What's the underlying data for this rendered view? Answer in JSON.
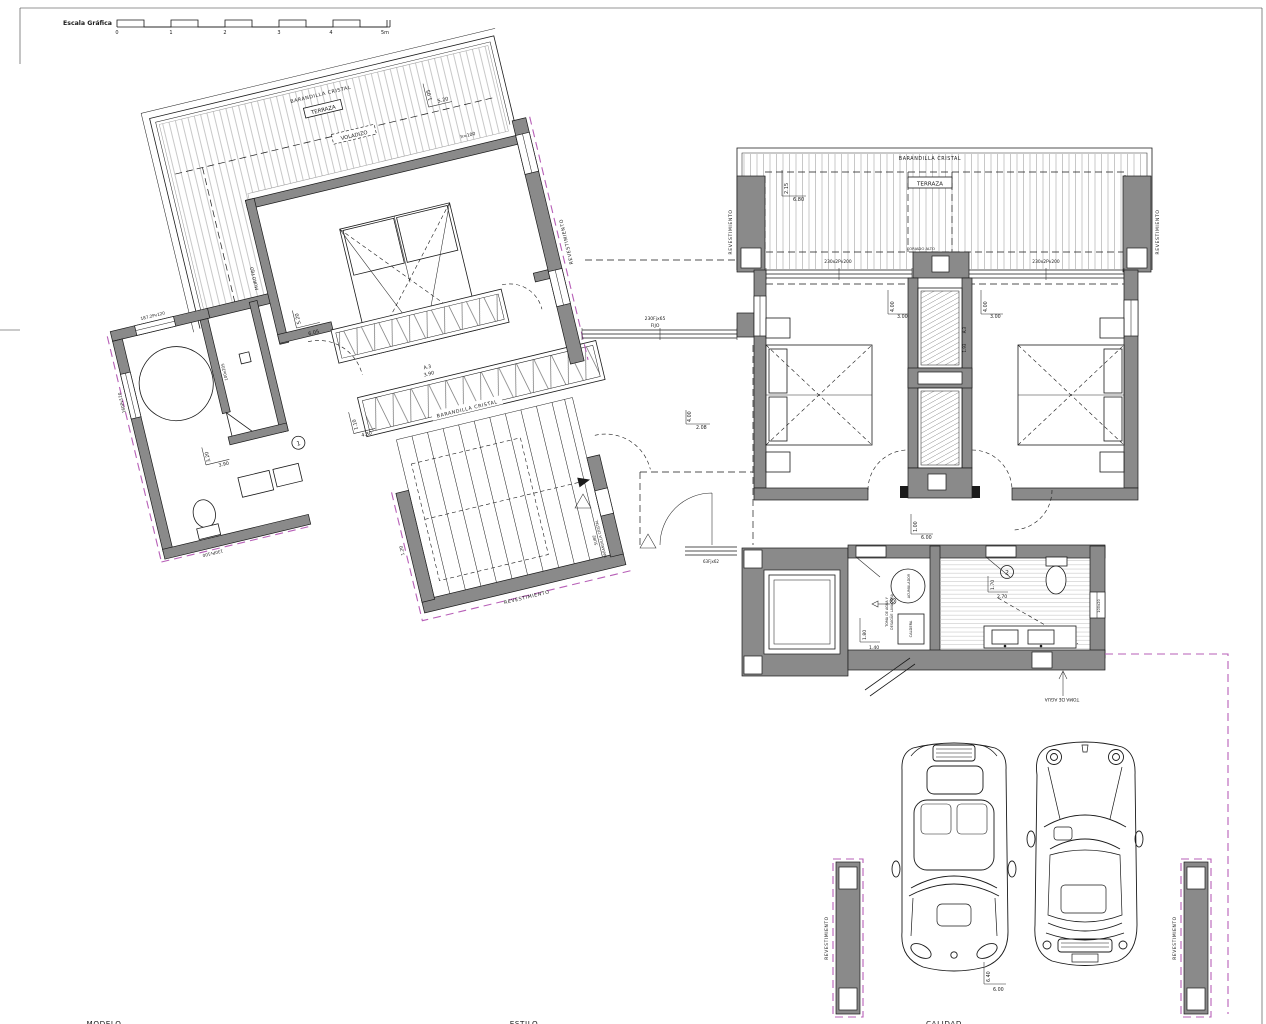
{
  "sheet": {
    "scale": {
      "label": "Escala Gráfica",
      "ticks": [
        "0",
        "1",
        "2",
        "3",
        "4",
        "5m"
      ]
    },
    "footer": {
      "modelo": "MODELO",
      "estilo": "ESTILO",
      "calidad": "CALIDAD"
    }
  },
  "colors": {
    "wall": "#8a8a8a",
    "line": "#1a1a1a",
    "magenta": "#b75fb7",
    "deck": "#adadad"
  },
  "left": {
    "terrace": {
      "railing": "BARANDILLA CRISTAL",
      "name": "TERRAZA",
      "voladizo": "VOLADIZO",
      "dim_v": "1.05",
      "dim_h": "5.20",
      "h_note": "h=100",
      "muro": "MURO FIJO"
    },
    "bedroom": {
      "dim_v": "5.20",
      "dim_h": "6.05"
    },
    "wardrobe": {
      "code": "A.3",
      "len": "3.90"
    },
    "hall_wardrobe": {
      "dim_v": "1.10",
      "dim_h": "4.30"
    },
    "bath": {
      "num": "1",
      "dim_v": "3.20",
      "dim_h": "3.90",
      "win_top": "187.2Pv120",
      "win_left": "160Pv120",
      "win_bottom": "130Pv100",
      "partition": "100x205"
    },
    "stairs": {
      "railing": "BARANDILLA CRISTAL",
      "clad": "REVESTIMIENTO",
      "sube": "SUBE",
      "railing2": "BARANDILLA CRISTAL",
      "dim_left": "1.20"
    },
    "clad_right": "REVESTIMIENTO"
  },
  "right": {
    "terrace": {
      "railing": "BARANDILLA CRISTAL",
      "name": "TERRAZA",
      "dim_v": "2.15",
      "dim_h": "6.80",
      "win_left": "230x2Pv200",
      "win_right": "230x2Pv200",
      "clad_left": "REVESTIMIENTO",
      "clad_right": "REVESTIMIENTO",
      "pier": "FORJADO ALTO"
    },
    "bedroom_l": {
      "dim_v": "4.00",
      "dim_h": "3.00"
    },
    "bedroom_r": {
      "dim_v": "4.00",
      "dim_h": "3.00"
    },
    "closet": {
      "code": "A.3",
      "len": "1.93"
    },
    "hall": {
      "win": "230Fjx65",
      "win_sub": "FIJO",
      "dim_v": "4.00",
      "dim_h": "2.08",
      "dim2_v": "1.00",
      "dim2_h": "6.00",
      "small_win": "63Fjx62"
    },
    "laundry": {
      "tank": "ACUMULADOR",
      "boiler": "CALDERA",
      "note1": "TOMA DE AGUA Y",
      "note2": "DESAGÜE LAVADORA",
      "dim_v": "1.80",
      "dim_h": "1.40"
    },
    "bath2": {
      "num": "2",
      "dim_v": "1.70",
      "dim_h": "2.70",
      "wall_note": "100x20"
    },
    "service": {
      "toma": "TOMA DE AGUA"
    },
    "garage": {
      "clad_left": "REVESTIMIENTO",
      "clad_right": "REVESTIMIENTO",
      "dim_v": "6.40",
      "dim_h": "6.00"
    }
  }
}
